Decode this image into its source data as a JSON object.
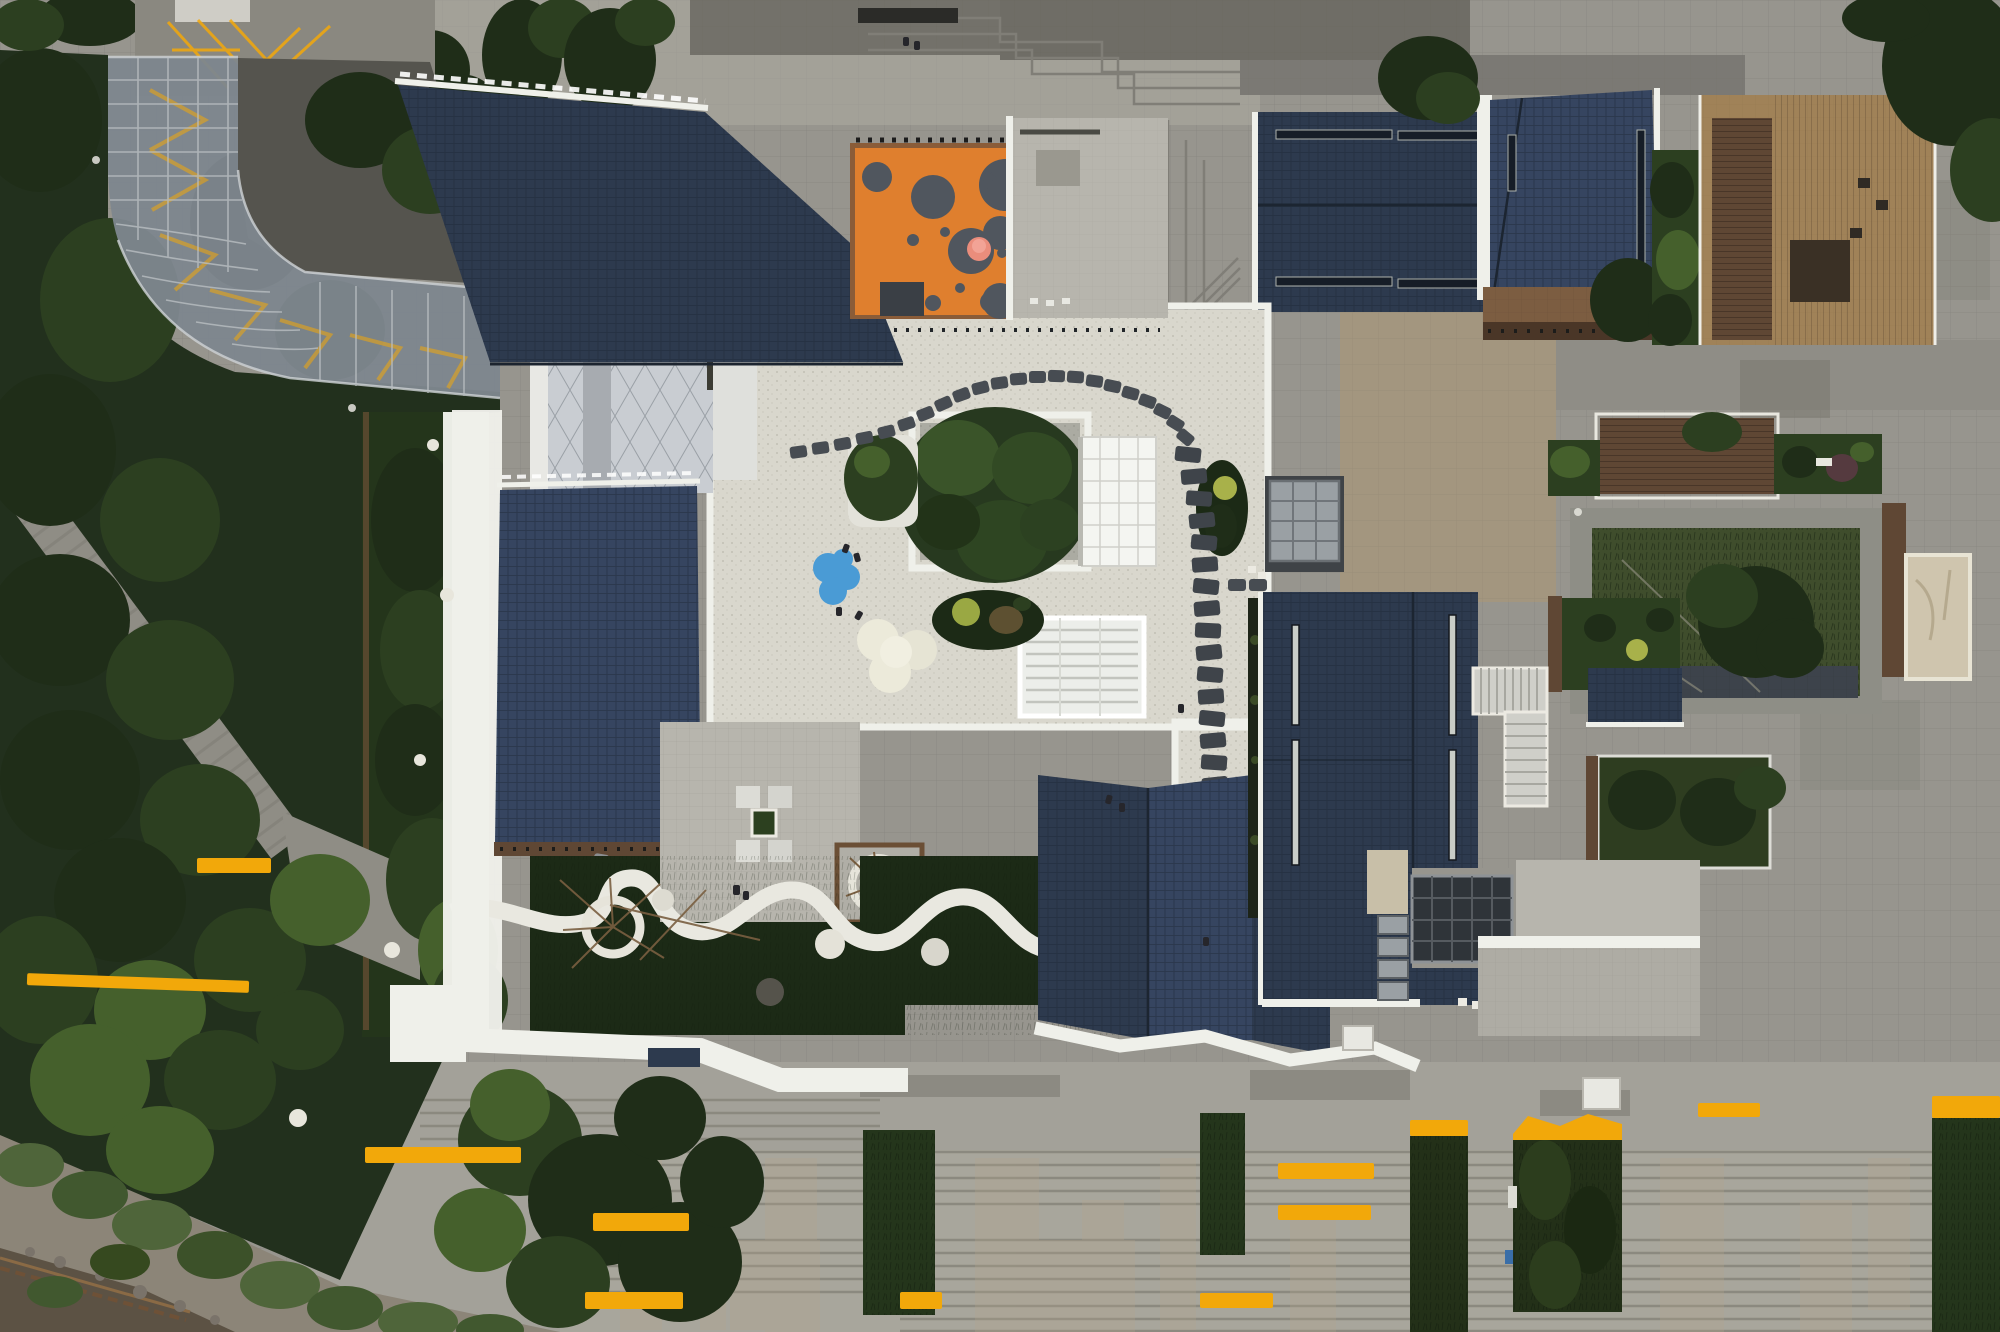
{
  "meta": {
    "title": "Aerial drone view of a kindergarten campus",
    "type": "aerial-photograph",
    "dimensions": "2000x1332",
    "time_of_day": "overcast dusk"
  },
  "palette": {
    "paving_base": "#97958e",
    "paving_light": "#a6a49b",
    "paving_dark": "#73716a",
    "terrace_gray": "#b7b5ad",
    "concrete": "#8e8c85",
    "tan_paving": "#a3967f",
    "roof_navy": "#2d3a4e",
    "roof_navy_light": "#364560",
    "white_trim": "#eff0ea",
    "gravel": "#d9d7cd",
    "play_orange": "#df7f2e",
    "play_circle": "#50565e",
    "play_pink": "#ea8d7c",
    "play_blue": "#4a9bd5",
    "tree_dark": "#1f2d18",
    "tree_mid": "#2c3f20",
    "tree_light": "#45602c",
    "lawn_dark": "#1c2a16",
    "lawn_garden": "#24351b",
    "deck_brown": "#5f4734",
    "brick": "#7c5d41",
    "wood_light": "#a08258",
    "glass_canopy": "#7e868e",
    "accent_yellow": "#f2a80a",
    "water": "#5c5244",
    "skylight_dark": "#2f3439"
  },
  "scene": {
    "regions": {
      "forest": {
        "label": "Dense tree canopy and park along the west side"
      },
      "canopy": {
        "label": "Curved glass entrance canopy over driveway with yellow chevron road markings"
      },
      "parking": {
        "label": "Small parking area with yellow cross-hatch markings"
      },
      "roof_a": {
        "label": "Main dark blue shingled roof, north-west block"
      },
      "roof_b": {
        "label": "Dark blue shingled roof, west block"
      },
      "roof_c": {
        "label": "Folded dark blue shingled roofs, south block"
      },
      "roof_d": {
        "label": "Dark blue shingled roof with linear skylights, east block"
      },
      "roof_e": {
        "label": "Long dark shingled roof with paired skylight slits, north-east block"
      },
      "roof_f": {
        "label": "Angled dark shingled roof, north-east annex"
      },
      "playground": {
        "label": "Orange rooftop playground with gray circles and pink play tube"
      },
      "courtyard": {
        "label": "White gravel courtyard with stepping-stone path, central tree and skylights"
      },
      "terrace": {
        "label": "Tiled roof terrace with bench cluster around a planter"
      },
      "garden": {
        "label": "Dark lawn garden with winding white path and ring planters"
      },
      "sunken_garden": {
        "label": "Framed roof garden with lawn and large tree, east side"
      },
      "deck": {
        "label": "Timber roof deck, east side"
      },
      "stair": {
        "label": "White exterior escape stair"
      },
      "plaza": {
        "label": "Broad stepped stone plaza with yellow painted benches, south side"
      },
      "river": {
        "label": "River bank with reeds and boardwalk, south-west corner"
      },
      "wood_building": {
        "label": "Timber-clad neighbour building, north-east corner"
      }
    },
    "counts": {
      "playground_circles": 15,
      "stepping_stones": 52,
      "yellow_benches": 13,
      "people_visible": 12
    }
  }
}
